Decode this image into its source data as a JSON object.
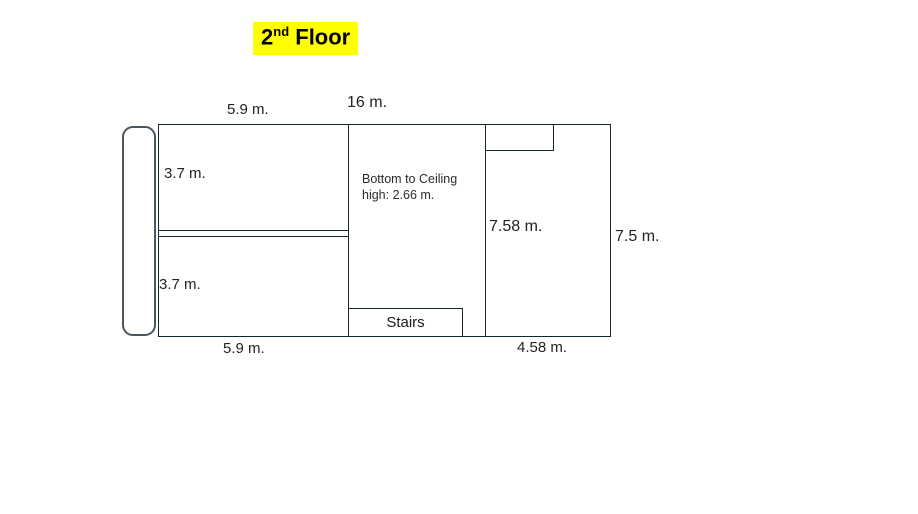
{
  "title": {
    "base": "2",
    "superscript": "nd",
    "rest": " Floor",
    "highlight_color": "#ffff00"
  },
  "floor_plan": {
    "line_color": "#13262e",
    "labels": {
      "top_left_width": "5.9 m.",
      "total_width": "16 m.",
      "upper_room_height": "3.7 m.",
      "lower_room_height": "3.7 m.",
      "right_room_height": "7.58 m.",
      "overall_height": "7.5 m.",
      "bottom_left_width": "5.9 m.",
      "bottom_right_width": "4.58 m.",
      "stairs": "Stairs",
      "ceiling_note_line1": "Bottom to Ceiling",
      "ceiling_note_line2": "high: 2.66 m."
    }
  }
}
